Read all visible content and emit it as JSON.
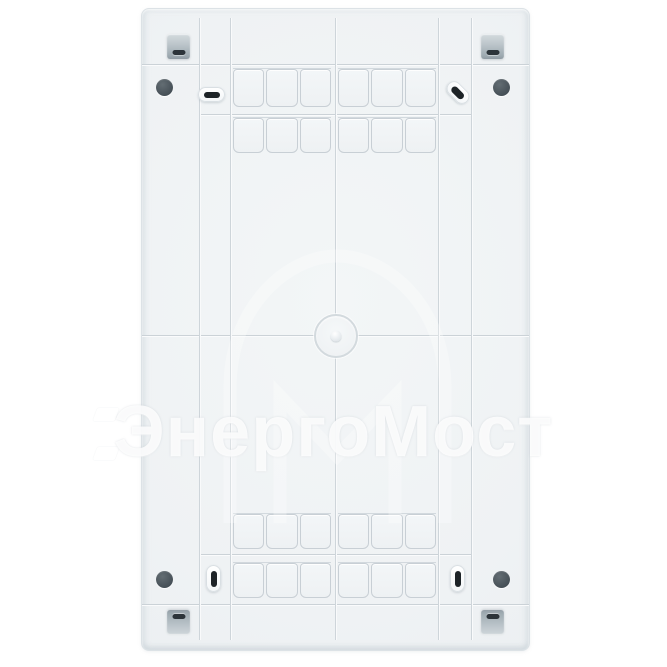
{
  "watermark": {
    "text": "ЭнергоМост"
  },
  "colors": {
    "page_background": "#ffffff",
    "panel_face": "#eff2f4",
    "groove_line": "#ccd3d8",
    "cell_border": "#c8cfd5",
    "mount_tab": "#a9b3ba",
    "tab_slot": "#2c343a",
    "screw_hole": "#4c565d",
    "cable_slot": "#1d2327",
    "watermark": "#ffffff"
  }
}
